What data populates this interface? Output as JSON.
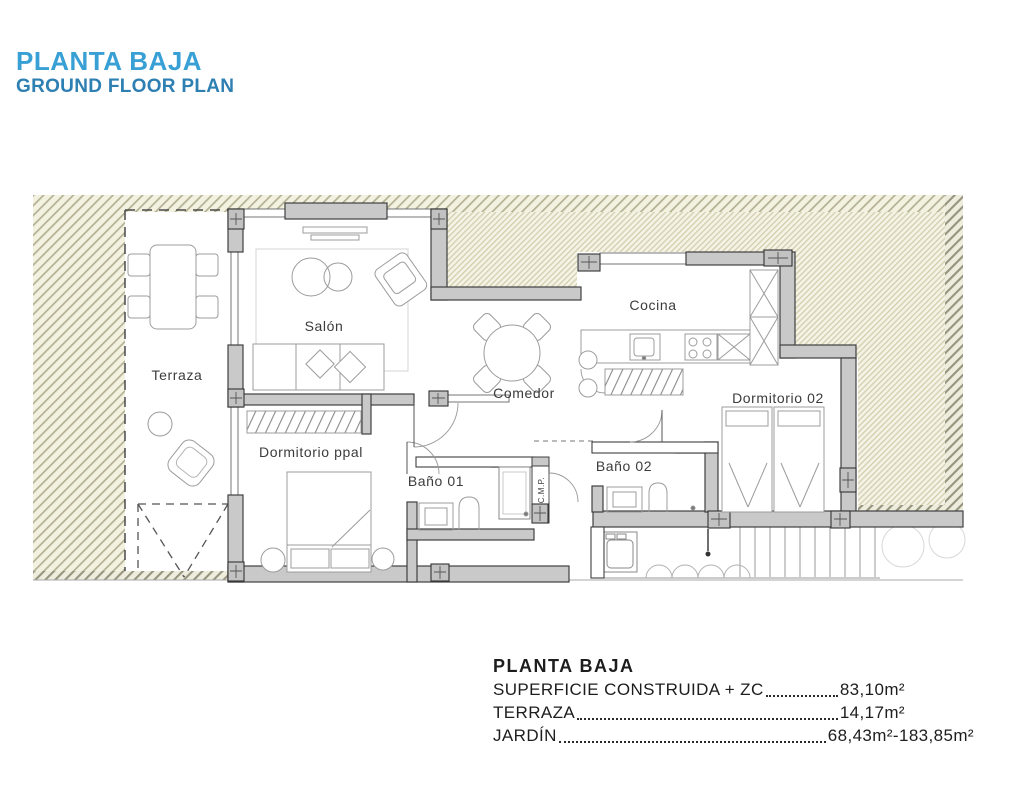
{
  "header": {
    "title": "PLANTA BAJA",
    "subtitle": "GROUND FLOOR PLAN"
  },
  "colors": {
    "title_blue": "#38A0D5",
    "subtitle_blue": "#2E7FB2",
    "hatch_fine_line": "#d2cead",
    "hatch_coarse_line": "#b3b094",
    "hatch_dark_line": "#96947e",
    "hatch_bg": "#f5f3e6",
    "wall_fill": "#c9c9c9",
    "wall_stroke": "#3f3f3f",
    "furniture_stroke": "#9c9c9c",
    "label_text": "#3c3c3c"
  },
  "plan": {
    "labels": {
      "terraza": "Terraza",
      "salon": "Salón",
      "cocina": "Cocina",
      "comedor": "Comedor",
      "dormitorio_ppal": "Dormitorio ppal",
      "dormitorio_02": "Dormitorio 02",
      "bano_01": "Baño 01",
      "bano_02": "Baño 02",
      "cmp": "C.M.P."
    }
  },
  "summary": {
    "heading": "PLANTA BAJA",
    "rows": [
      {
        "label": "SUPERFICIE CONSTRUIDA + ZC",
        "value": "83,10m²"
      },
      {
        "label": "TERRAZA",
        "value": "14,17m²"
      },
      {
        "label": "JARDÍN",
        "value": "68,43m²-183,85m²"
      }
    ]
  }
}
